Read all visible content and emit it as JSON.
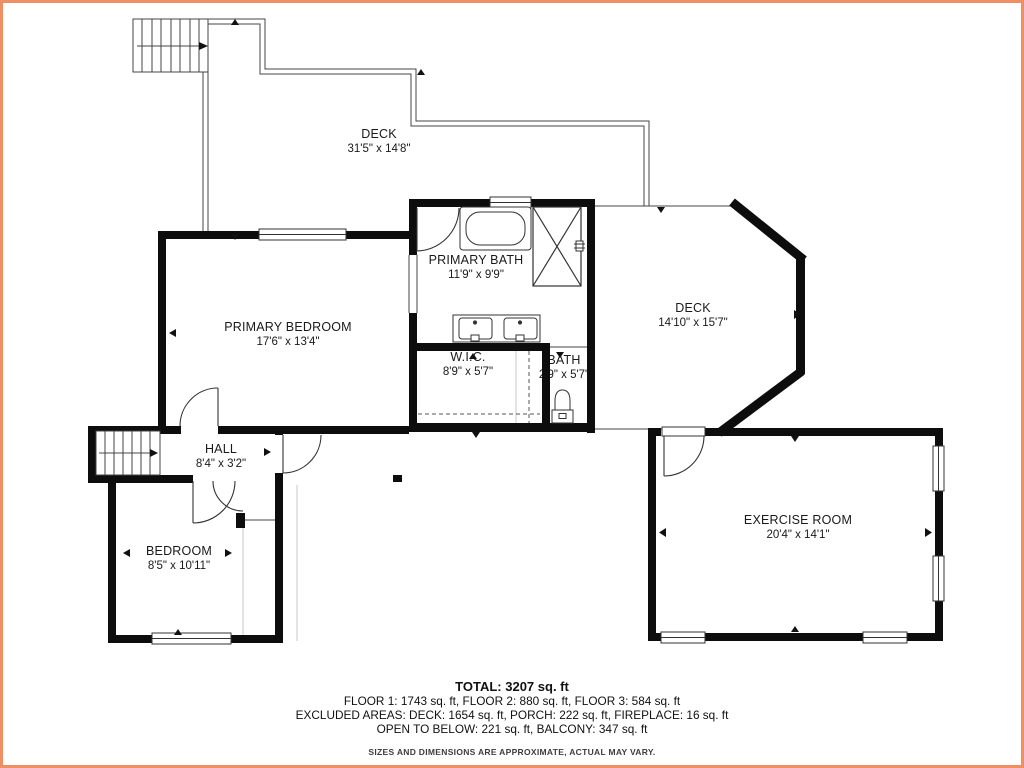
{
  "rooms": {
    "deck_top": {
      "name": "DECK",
      "dims": "31'5\" x 14'8\""
    },
    "primary_bath": {
      "name": "PRIMARY BATH",
      "dims": "11'9\" x 9'9\""
    },
    "primary_bedroom": {
      "name": "PRIMARY BEDROOM",
      "dims": "17'6\" x 13'4\""
    },
    "deck_right": {
      "name": "DECK",
      "dims": "14'10\" x 15'7\""
    },
    "wic": {
      "name": "W.I.C.",
      "dims": "8'9\" x 5'7\""
    },
    "bath": {
      "name": "BATH",
      "dims": "2'9\" x 5'7\""
    },
    "hall": {
      "name": "HALL",
      "dims": "8'4\" x 3'2\""
    },
    "bedroom": {
      "name": "BEDROOM",
      "dims": "8'5\" x 10'11\""
    },
    "exercise_room": {
      "name": "EXERCISE ROOM",
      "dims": "20'4\" x 14'1\""
    }
  },
  "summary": {
    "total": "TOTAL: 3207 sq. ft",
    "floors": "FLOOR 1: 1743 sq. ft, FLOOR 2: 880 sq. ft, FLOOR 3: 584 sq. ft",
    "excluded": "EXCLUDED AREAS: DECK: 1654 sq. ft, PORCH: 222 sq. ft, FIREPLACE: 16 sq. ft",
    "open_below": "OPEN TO BELOW: 221 sq. ft, BALCONY: 347 sq. ft",
    "disclaimer": "SIZES AND DIMENSIONS ARE APPROXIMATE, ACTUAL MAY VARY."
  },
  "fixtures": [
    "stairs",
    "bathtub",
    "shower",
    "double-vanity",
    "toilet",
    "doors",
    "windows",
    "fireplace-marker"
  ],
  "colors": {
    "wall": "#0d0d0d",
    "thin_line": "#444444",
    "light_line": "#c9c9c9",
    "border": "#ef8f63"
  }
}
